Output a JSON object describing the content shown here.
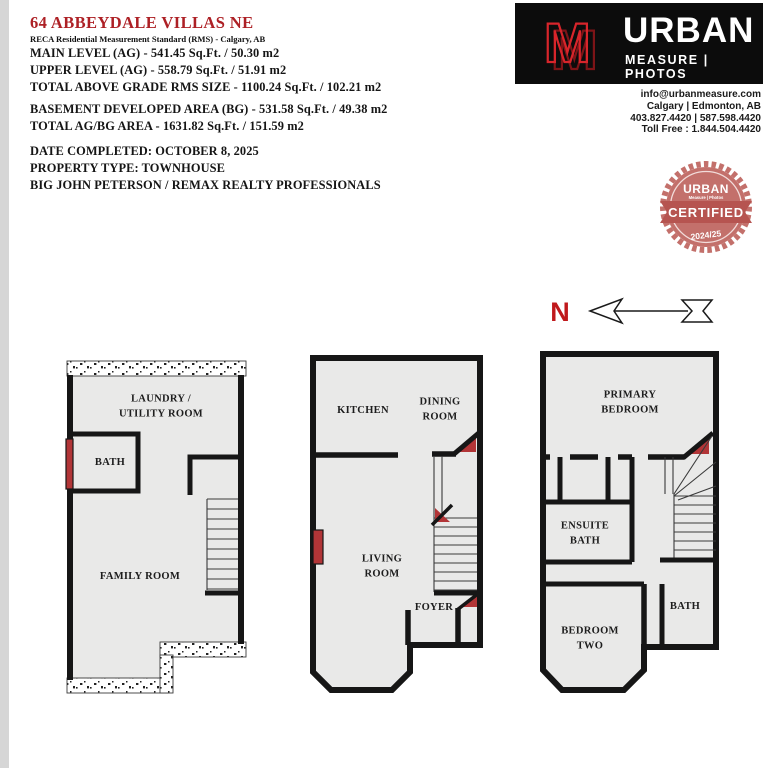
{
  "header": {
    "title": "64 ABBEYDALE VILLAS NE",
    "subtitle": "RECA Residential Measurement Standard (RMS) - Calgary, AB",
    "rms_lines": [
      "MAIN LEVEL (AG) - 541.45 Sq.Ft. / 50.30 m2",
      "UPPER LEVEL (AG) - 558.79 Sq.Ft. / 51.91 m2",
      "TOTAL ABOVE GRADE RMS SIZE - 1100.24 Sq.Ft. / 102.21 m2"
    ],
    "bg_lines": [
      "BASEMENT DEVELOPED AREA (BG) - 531.58 Sq.Ft. / 49.38 m2",
      "TOTAL AG/BG AREA - 1631.82 Sq.Ft. / 151.59 m2"
    ],
    "meta_lines": [
      "DATE COMPLETED: OCTOBER 8, 2025",
      "PROPERTY TYPE: TOWNHOUSE",
      "BIG JOHN PETERSON / REMAX REALTY PROFESSIONALS"
    ],
    "title_color": "#ad2025"
  },
  "brand": {
    "name": "URBAN",
    "tagline": "MEASURE | PHOTOS",
    "logo_letter": "M",
    "logo_red": "#d8252b",
    "box_black": "#0c0c0c",
    "contact_lines": [
      "info@urbanmeasure.com",
      "Calgary | Edmonton, AB",
      "403.827.4420 | 587.598.4420",
      "Toll Free : 1.844.504.4420"
    ]
  },
  "badge": {
    "brand": "URBAN",
    "brand_sub": "Measure | Photos",
    "label": "CERTIFIED",
    "years": "2024/25",
    "seal_color": "#c3706b",
    "ribbon_color": "#b65450"
  },
  "compass": {
    "label": "N",
    "color": "#c0191c"
  },
  "floorplans": {
    "accent_red": "#b23537",
    "basement": {
      "laundry_utility": "LAUNDRY /\nUTILITY ROOM",
      "bath": "BATH",
      "family": "FAMILY ROOM"
    },
    "main": {
      "kitchen": "KITCHEN",
      "dining": "DINING\nROOM",
      "living": "LIVING\nROOM",
      "foyer": "FOYER"
    },
    "upper": {
      "primary": "PRIMARY BEDROOM",
      "ensuite": "ENSUITE\nBATH",
      "bath": "BATH",
      "bedroom_two": "BEDROOM\nTWO"
    }
  }
}
